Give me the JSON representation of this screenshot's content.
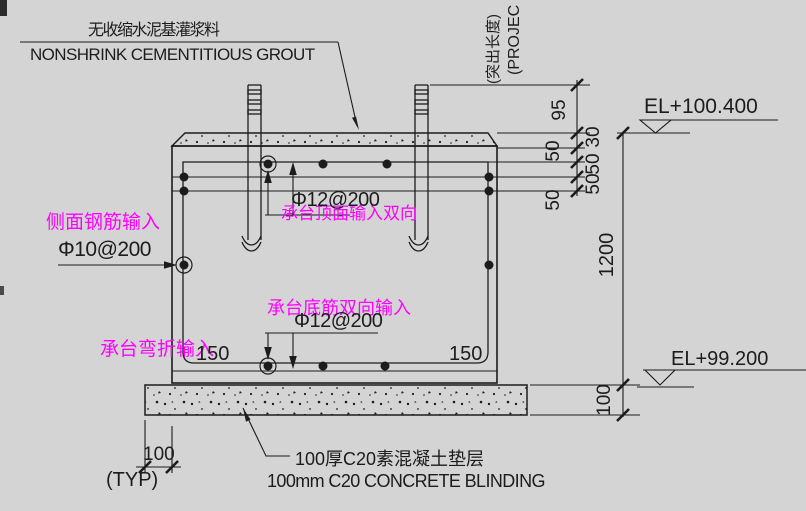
{
  "colors": {
    "background": "#d4d4d4",
    "ink": "#1c1c1c",
    "grip": "#ff00ff"
  },
  "notes": {
    "grout_cn": "无收缩水泥基灌浆料",
    "grout_en": "NONSHRINK CEMENTITIOUS GROUT",
    "blinding_cn": "100厚C20素混凝土垫层",
    "blinding_en": "100mm C20 CONCRETE BLINDING",
    "projection_cn": "(突出长度)",
    "projection_en": "(PROJEC"
  },
  "levels": {
    "top": "EL+100.400",
    "bottom": "EL+99.200"
  },
  "rebar_labels": {
    "side": "Φ10@200",
    "top": "Φ12@200",
    "bottom": "Φ12@200"
  },
  "grips": {
    "side": "侧面钢筋输入",
    "top": "承台顶面输入双向",
    "bottom": "承台底筋双向输入",
    "bend": "承台弯折输入"
  },
  "dims": {
    "bolt_projection": "95",
    "grout_thickness": "30",
    "spacing_a": "50",
    "spacing_b": "50",
    "spacing_c": "50",
    "spacing_d": "50",
    "cap_height": "1200",
    "blinding_thickness": "100",
    "edge_left": "150",
    "edge_right": "150",
    "blinding_overhang": "100",
    "typical": "(TYP)"
  }
}
